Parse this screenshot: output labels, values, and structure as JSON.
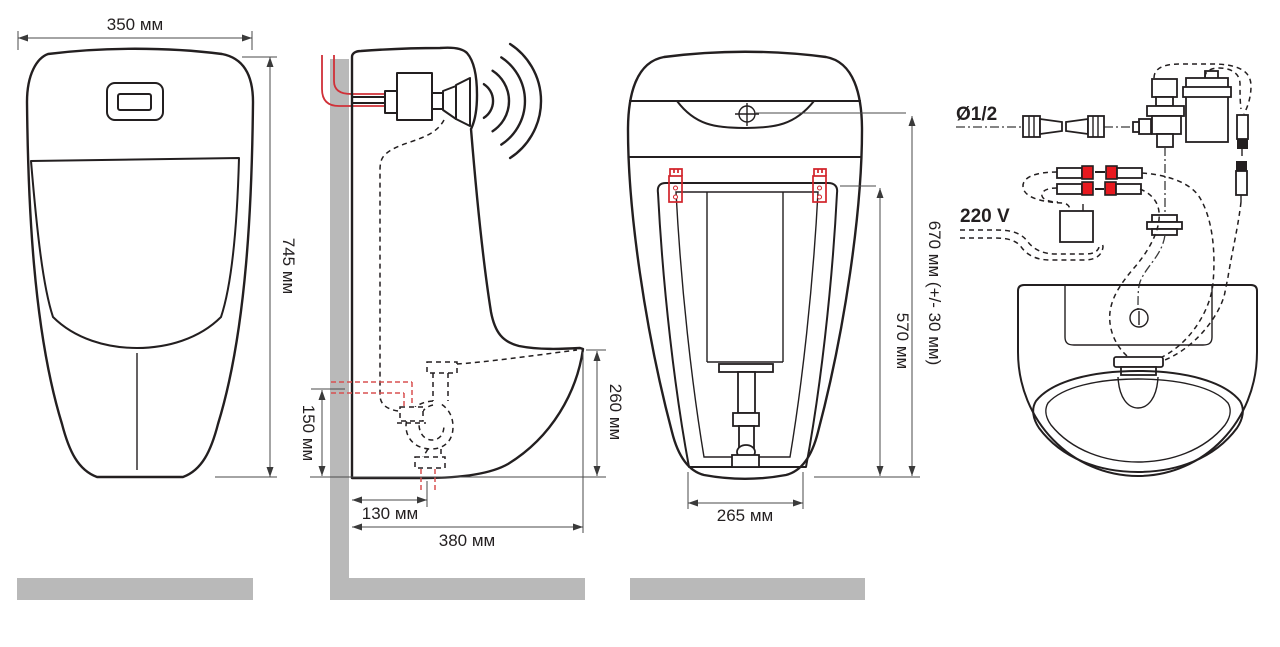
{
  "front_view": {
    "width": "350 мм",
    "height": "745 мм"
  },
  "side_view": {
    "outlet_height": "150 мм",
    "outlet_offset": "130 мм",
    "depth": "380 мм",
    "front_height": "260 мм"
  },
  "back_view": {
    "inlet_height": "670 мм (+/- 30 мм)",
    "bracket_height": "570 мм",
    "base_width": "265 мм"
  },
  "installation": {
    "water_connection": "Ø1/2",
    "power": "220 V"
  },
  "colors": {
    "line": "#231f20",
    "red": "#d2232a",
    "gray": "#b9b9b9",
    "dim": "#4a4a4a"
  }
}
